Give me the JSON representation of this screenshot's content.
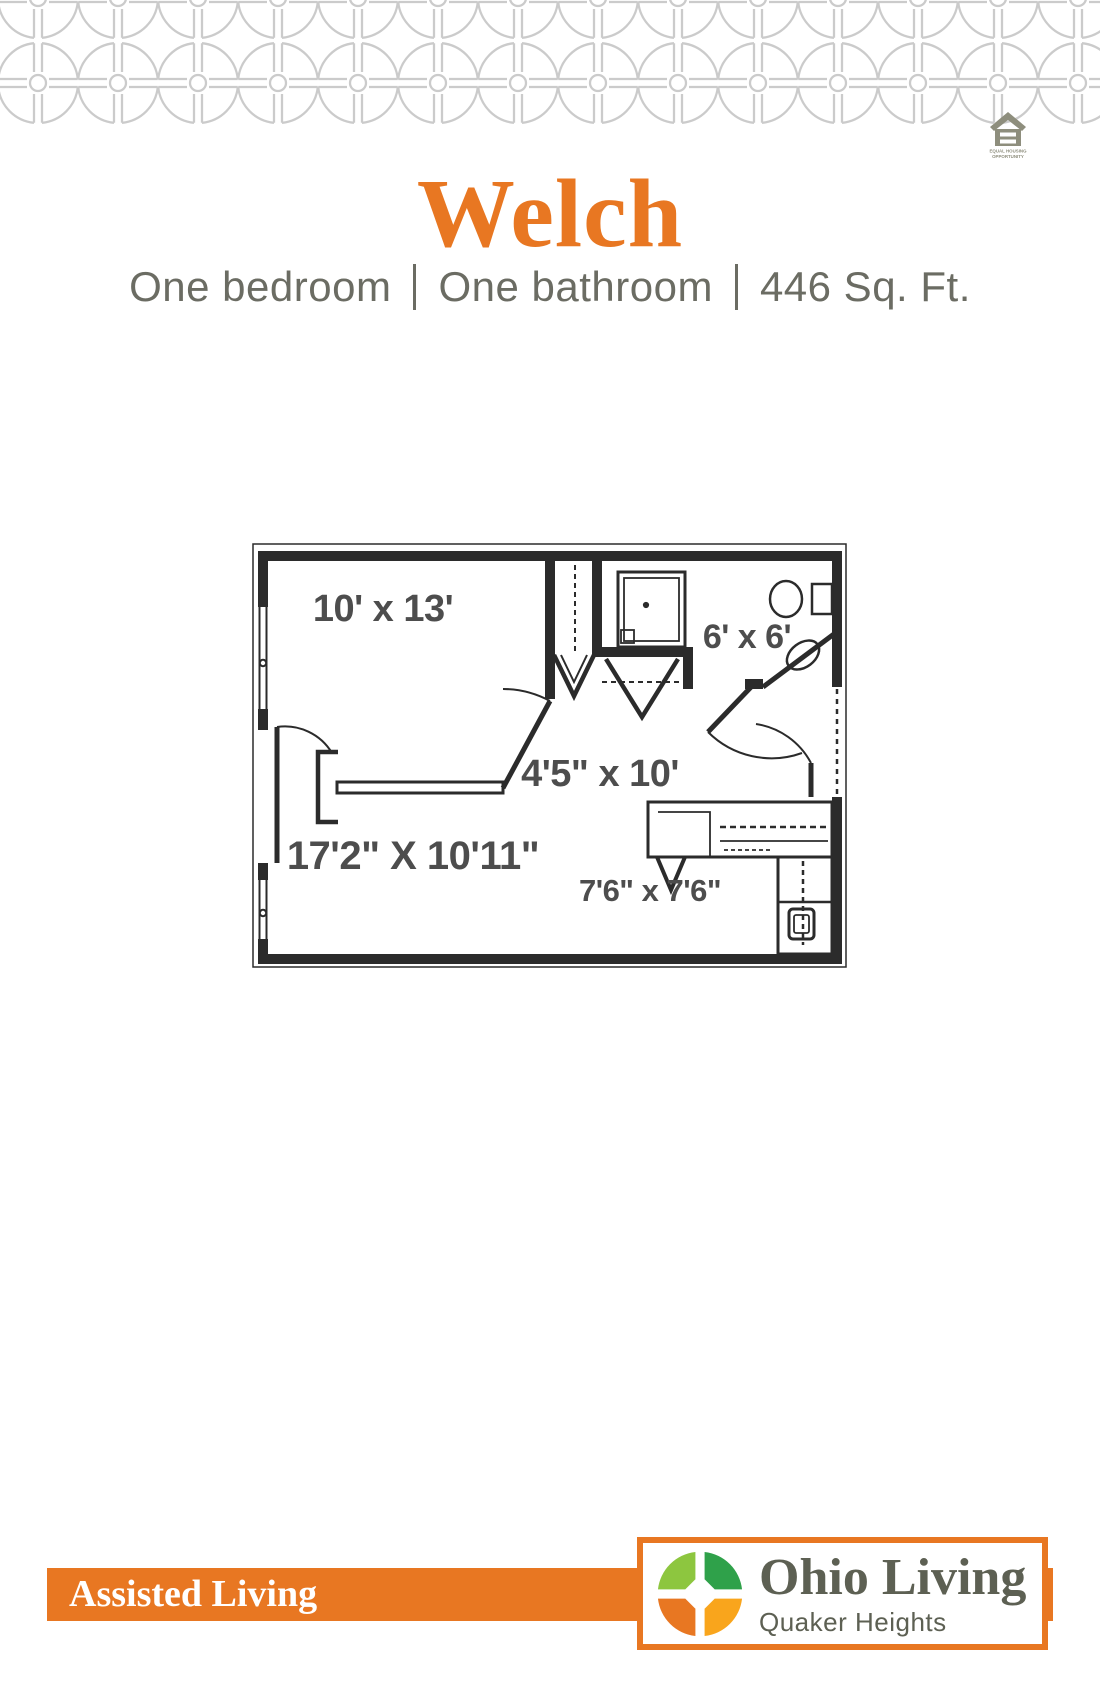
{
  "page": {
    "title": "Welch",
    "subtitle_parts": [
      "One bedroom",
      "One bathroom",
      "446 Sq. Ft."
    ]
  },
  "floor_plan": {
    "rooms": [
      {
        "id": "bedroom",
        "label": "10' x 13'"
      },
      {
        "id": "bathroom",
        "label": "6' x 6'"
      },
      {
        "id": "hallway",
        "label": "4'5\" x 10'"
      },
      {
        "id": "living-room",
        "label": "17'2\" X 10'11\""
      },
      {
        "id": "kitchen",
        "label": "7'6\" x 7'6\""
      }
    ]
  },
  "footer": {
    "banner_label": "Assisted Living",
    "logo_name": "Ohio Living",
    "logo_subname": "Quaker Heights"
  },
  "equal_housing": {
    "line1": "EQUAL HOUSING",
    "line2": "OPPORTUNITY"
  },
  "colors": {
    "brand_orange": "#E87722",
    "subtitle_gray": "#6B6C63",
    "pattern_gray": "#CBCBCB",
    "plan_line": "#2B2B2B",
    "plan_label_gray": "#4D4D4D",
    "logo_text_gray": "#5D6053",
    "logo_light_green": "#8DC63F",
    "logo_green": "#2FA14A",
    "logo_amber": "#F9A51C",
    "logo_orange": "#E87722",
    "equal_housing_gray": "#8E8E7D"
  }
}
